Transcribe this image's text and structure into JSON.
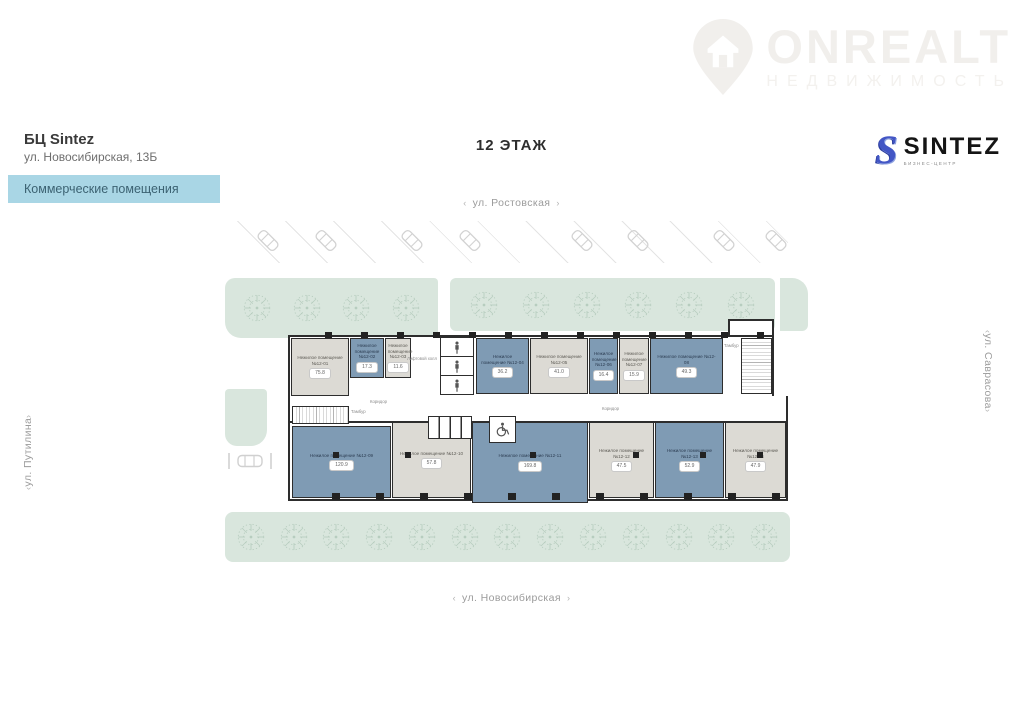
{
  "watermark": {
    "text": "ONREALT",
    "subtext": "НЕДВИЖИМОСТЬ"
  },
  "header": {
    "building_name": "БЦ Sintez",
    "address": "ул. Новосибирская, 13Б",
    "banner": "Коммерческие помещения"
  },
  "floor_title": "12 ЭТАЖ",
  "brand": {
    "name": "SINTEZ",
    "subtitle": "БИЗНЕС-ЦЕНТР"
  },
  "streets": {
    "top": "ул. Ростовская",
    "bottom": "ул. Новосибирская",
    "left": "ул. Путилина",
    "right": "ул. Саврасова",
    "arrow_left": "‹",
    "arrow_right": "›"
  },
  "plan": {
    "corridor_label": "Коридор",
    "lift_hall_label": "Лифтовой холл",
    "vestibule_label": "Тамбур",
    "colors": {
      "room_blue": "#7f9bb4",
      "room_gray": "#dcdad4",
      "greenery": "#d9e6dd",
      "banner_blue": "#a9d6e5"
    },
    "rooms": [
      {
        "name": "Нежилое помещение №12-01",
        "area": "75.8"
      },
      {
        "name": "Нежилое помещение №12-02",
        "area": "17.3"
      },
      {
        "name": "Нежилое помещение №12-03",
        "area": "11.6"
      },
      {
        "name": "Нежилое помещение №12-04",
        "area": "36.2"
      },
      {
        "name": "Нежилое помещение №12-05",
        "area": "41.0"
      },
      {
        "name": "Нежилое помещение №12-06",
        "area": "16.4"
      },
      {
        "name": "Нежилое помещение №12-07",
        "area": "15.9"
      },
      {
        "name": "Нежилое помещение №12-08",
        "area": "49.3"
      },
      {
        "name": "Нежилое помещение №12-09",
        "area": "120.9"
      },
      {
        "name": "Нежилое помещение №12-10",
        "area": "57.8"
      },
      {
        "name": "Нежилое помещение №12-11",
        "area": "169.8"
      },
      {
        "name": "Нежилое помещение №12-12",
        "area": "47.5"
      },
      {
        "name": "Нежилое помещение №12-13",
        "area": "52.9"
      },
      {
        "name": "Нежилое помещение №12-14",
        "area": "47.9"
      }
    ]
  }
}
